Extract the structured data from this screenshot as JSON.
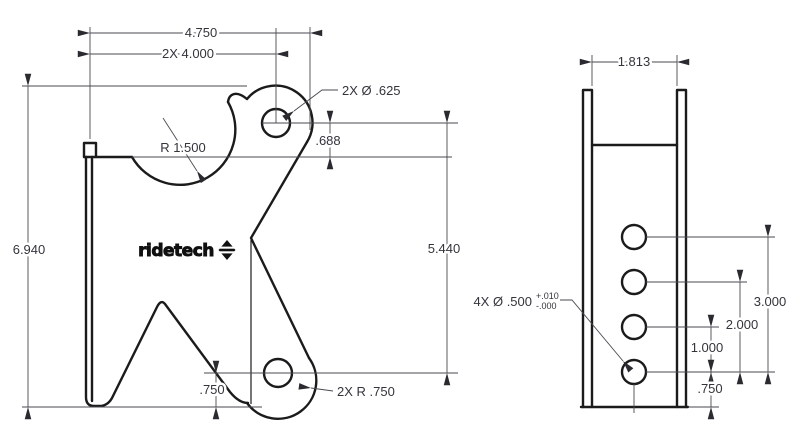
{
  "drawing_title": "bracket two-view dimensioned drawing",
  "front_view": {
    "width_overall": "4.750",
    "hole_spacing": "2X 4.000",
    "top_holes_callout": "2X Ø .625",
    "cutout_radius": "R 1.500",
    "top_hole_offset": ".688",
    "height_overall": "6.940",
    "hole_to_hole": "5.440",
    "bottom_hole_offset": ".750",
    "bottom_radius_callout": "2X R .750",
    "logo": "ridetech"
  },
  "side_view": {
    "width": "1.813",
    "holes_callout": "4X Ø .500",
    "tolerance_plus": "+.010",
    "tolerance_minus": "-.000",
    "span_three": "3.000",
    "span_two": "2.000",
    "span_one": "1.000",
    "bottom_offset": ".750"
  },
  "colors": {
    "background": "#ffffff",
    "part_line": "#1b1b1b",
    "dimension_line": "#4a4a52",
    "dimension_text": "#34343c"
  }
}
